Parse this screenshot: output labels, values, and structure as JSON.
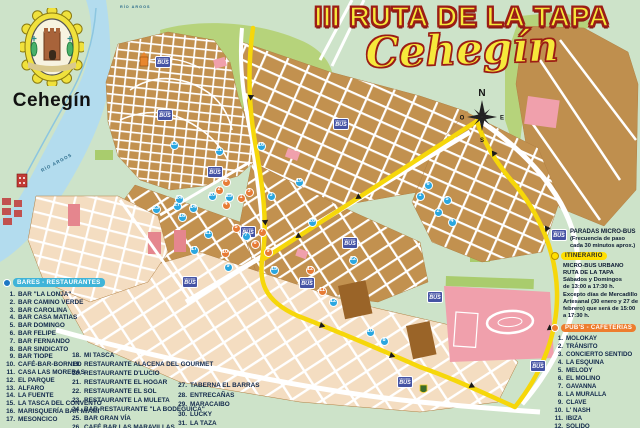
{
  "emblem": {
    "town_label": "Cehegín"
  },
  "title": {
    "main": "III RUTA DE LA TAPA",
    "script": "Cehegín"
  },
  "compass": {
    "north": "N",
    "south": "S",
    "east": "E",
    "west": "O"
  },
  "colors": {
    "route_yellow": "#f6d70a",
    "bares_accent": "#3fb4d8",
    "pubs_accent": "#ed7d2e",
    "marker_blue": "#2aa7e0",
    "marker_orange": "#e77b35",
    "bus_sign_blue": "#4553a4",
    "title_fill": "#f6e93b",
    "title_outline": "#9c1d15"
  },
  "map": {
    "river_label": "RÍO ARGOS",
    "bus_sign": {
      "line1": "MICRO",
      "line2": "BUS"
    },
    "bus_signs": [
      [
        163,
        62
      ],
      [
        165,
        115
      ],
      [
        215,
        172
      ],
      [
        248,
        232
      ],
      [
        341,
        124
      ],
      [
        307,
        283
      ],
      [
        350,
        243
      ],
      [
        405,
        382
      ],
      [
        538,
        366
      ],
      [
        435,
        297
      ],
      [
        190,
        282
      ]
    ],
    "blue_stops": [
      {
        "n": "13",
        "x": 174,
        "y": 145
      },
      {
        "n": "21",
        "x": 219,
        "y": 151
      },
      {
        "n": "16",
        "x": 261,
        "y": 146
      },
      {
        "n": "19",
        "x": 299,
        "y": 182
      },
      {
        "n": "23",
        "x": 156,
        "y": 209
      },
      {
        "n": "27",
        "x": 177,
        "y": 206
      },
      {
        "n": "24",
        "x": 179,
        "y": 199
      },
      {
        "n": "14",
        "x": 193,
        "y": 208
      },
      {
        "n": "18",
        "x": 182,
        "y": 217
      },
      {
        "n": "20",
        "x": 212,
        "y": 196
      },
      {
        "n": "25",
        "x": 229,
        "y": 197
      },
      {
        "n": "11",
        "x": 208,
        "y": 234
      },
      {
        "n": "17",
        "x": 194,
        "y": 250
      },
      {
        "n": "7",
        "x": 246,
        "y": 236
      },
      {
        "n": "9",
        "x": 228,
        "y": 267
      },
      {
        "n": "15",
        "x": 274,
        "y": 270
      },
      {
        "n": "3",
        "x": 271,
        "y": 196
      },
      {
        "n": "22",
        "x": 353,
        "y": 260
      },
      {
        "n": "26",
        "x": 312,
        "y": 222
      },
      {
        "n": "6",
        "x": 428,
        "y": 185
      },
      {
        "n": "5",
        "x": 447,
        "y": 200
      },
      {
        "n": "2",
        "x": 438,
        "y": 212
      },
      {
        "n": "1",
        "x": 420,
        "y": 196
      },
      {
        "n": "4",
        "x": 452,
        "y": 222
      },
      {
        "n": "12",
        "x": 333,
        "y": 302
      },
      {
        "n": "10",
        "x": 370,
        "y": 332
      },
      {
        "n": "8",
        "x": 384,
        "y": 341
      }
    ],
    "orange_stops": [
      {
        "n": "2",
        "x": 219,
        "y": 190
      },
      {
        "n": "8",
        "x": 226,
        "y": 182
      },
      {
        "n": "4",
        "x": 226,
        "y": 205
      },
      {
        "n": "1",
        "x": 241,
        "y": 198
      },
      {
        "n": "3",
        "x": 249,
        "y": 192
      },
      {
        "n": "5",
        "x": 236,
        "y": 228
      },
      {
        "n": "6",
        "x": 255,
        "y": 244
      },
      {
        "n": "7",
        "x": 262,
        "y": 232
      },
      {
        "n": "10",
        "x": 225,
        "y": 253
      },
      {
        "n": "9",
        "x": 268,
        "y": 252
      },
      {
        "n": "11",
        "x": 322,
        "y": 291
      },
      {
        "n": "12",
        "x": 310,
        "y": 270
      }
    ]
  },
  "legend": {
    "paradas": {
      "title": "PARADAS MICRO-BUS",
      "note": "(Frecuencia de paso cada 30 minutos aprox.)"
    },
    "itinerario_label": "ITINERARIO",
    "schedule": {
      "line1": "MICRO-BUS URBANO",
      "line2": "RUTA DE LA TAPA",
      "line3": "Sábados y Domingos",
      "line4": "de 13:00 a 17:30 h.",
      "note": "Excepto días de Mercadillo Artesanal (30 enero y 27 de febrero) que será de 15:00 a 17:30 h."
    }
  },
  "bares": {
    "header": "BARES - RESTAURANTES",
    "columns": [
      {
        "start": 1,
        "names": [
          "BAR \"LA LONJA\"",
          "BAR CAMINO VERDE",
          "BAR CAROLINA",
          "BAR CASA MATIAS",
          "BAR DOMINGO",
          "BAR FELIPE",
          "BAR FERNANDO",
          "BAR SINDICATO",
          "BAR TIOPE",
          "CAFÉ-BAR-BORNEO",
          "CASA LAS MORERAS",
          "EL PARQUE",
          "ALFARO",
          "LA FUENTE",
          "LA TASCA DEL CONVENTO",
          "MARISQUERÍA BAR MIAMI",
          "MESONCICO"
        ]
      },
      {
        "start": 18,
        "names": [
          "MI TASCA",
          "RESTAURANTE ALACENA DEL GOURMET",
          "RESTAURANTE D'LUCIO",
          "RESTAURANTE EL HOGAR",
          "RESTAURANTE EL SOL",
          "RESTAURANTE LA MULETA",
          "BAR-RESTAURANTE \"LA BODEGUICA\"",
          "BAR GRAN VÍA",
          "CAFÉ BAR LAS MARAVILLAS"
        ]
      },
      {
        "start": 27,
        "names": [
          "TABERNA EL BARRAS",
          "ENTRECAÑAS",
          "MARACAIBO",
          "LUCKY",
          "LA TAZA"
        ]
      }
    ]
  },
  "pubs": {
    "header": "PUB'S - CAFETERIAS",
    "start": 1,
    "names": [
      "MOLOKAY",
      "TRÁNSITO",
      "CONCIERTO SENTIDO",
      "LA ESQUINA",
      "MELODY",
      "EL MOLINO",
      "GAVANNA",
      "LA MURALLA",
      "CLAVE",
      "L' NASH",
      "IBIZA",
      "SOLIDO"
    ]
  }
}
